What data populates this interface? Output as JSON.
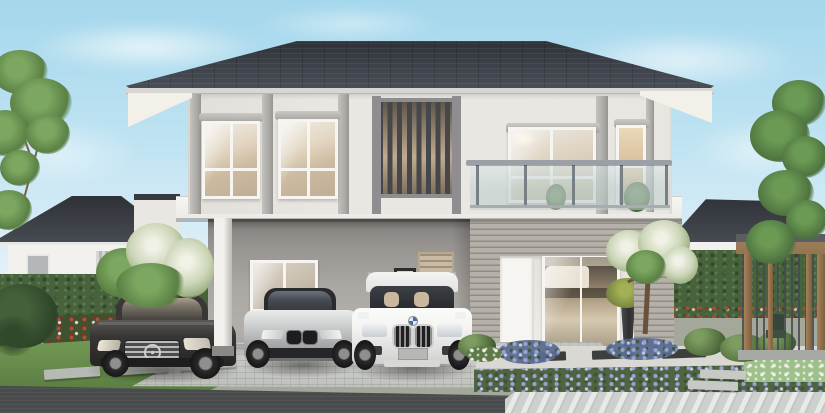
{
  "scene": {
    "type": "architectural-exterior-rendering",
    "time_of_day": "day",
    "description": "Photorealistic daytime rendering of a modern two-storey detached house with light grey walls and a charcoal hip roof. A carport under the overhanging second floor shelters three cars: a dark grey Mercedes-Benz sedan, a silver BMW coupe and a white BMW SUV. The upper floor has white-framed sliding windows, a dark vertical louvre screen and a glass-railed balcony. Landscaped garden with trimmed hedges, red and purple flower beds, lawns with stepping stones, white flowering shrubs, a timber garden pavilion with dark slats, paver driveway and single-storey neighbour houses on both sides.",
    "objects": [
      {
        "name": "main-house",
        "details": "two storeys, charcoal hip roof, cream soffit, grey pilasters, vertical louvre screen, glass balcony, grey horizontal-sided portal around entrance"
      },
      {
        "name": "carport",
        "details": "open bay under second floor with white column, grey rear wall, interior window, framed wall art and tan louvred door"
      },
      {
        "name": "car-mercedes-sedan",
        "color": "dark grey",
        "position": "left bay"
      },
      {
        "name": "car-bmw-coupe",
        "color": "silver",
        "position": "middle bay"
      },
      {
        "name": "car-bmw-suv",
        "color": "white",
        "position": "right bay"
      },
      {
        "name": "entrance",
        "details": "white front door and sliding glass door showing living room with beige sofa, dark potted plant beside"
      },
      {
        "name": "neighbour-house-left",
        "details": "single storey, dark hip roof, white walls behind hedge"
      },
      {
        "name": "neighbour-house-right",
        "details": "single storey, dark hip roof, white walls behind hedge"
      },
      {
        "name": "garden-pavilion",
        "details": "flat-roofed timber structure with dark vertical slats and a chair"
      },
      {
        "name": "landscaping",
        "details": "hedges, red/white flower bed, purple flower bed, lawns, stepping stones, white flowering shrub and tree, round bushes"
      },
      {
        "name": "ground",
        "details": "cobblestone paver driveway, dark asphalt road, light diagonal-striped walkway"
      }
    ]
  },
  "palette": {
    "sky_top": "#a5d7ec",
    "sky_bottom": "#f7fbfd",
    "roof_dark": "#383c42",
    "fascia": "#d7d6d2",
    "soffit": "#f3f0ea",
    "wall_upper": "#eae7e2",
    "wall_slab": "#f7f6f2",
    "wall_recess": "#efece7",
    "carport_wall": "#a8a4a0",
    "siding_gray": "#a7a29b",
    "window_frame": "#f6f5f2",
    "glass_warm": "#d8c8ae",
    "louver_slat": "#46474b",
    "balcony_glass": "#d4e2e4",
    "rail_gray": "#9aa0a5",
    "hedge_green": "#47633b",
    "lawn_green": "#6f9552",
    "blossom_white": "#eef0e3",
    "flower_red": "#c24836",
    "flower_purple": "#9aa1d4",
    "wood_brown": "#96764f",
    "paver_gray": "#bfc1bd",
    "road_asphalt": "#4a4b4d",
    "walkway_light": "#cdd1cd",
    "car_dark": "#383635",
    "car_silver": "#c6c7c8",
    "car_white": "#f4f4f2"
  }
}
